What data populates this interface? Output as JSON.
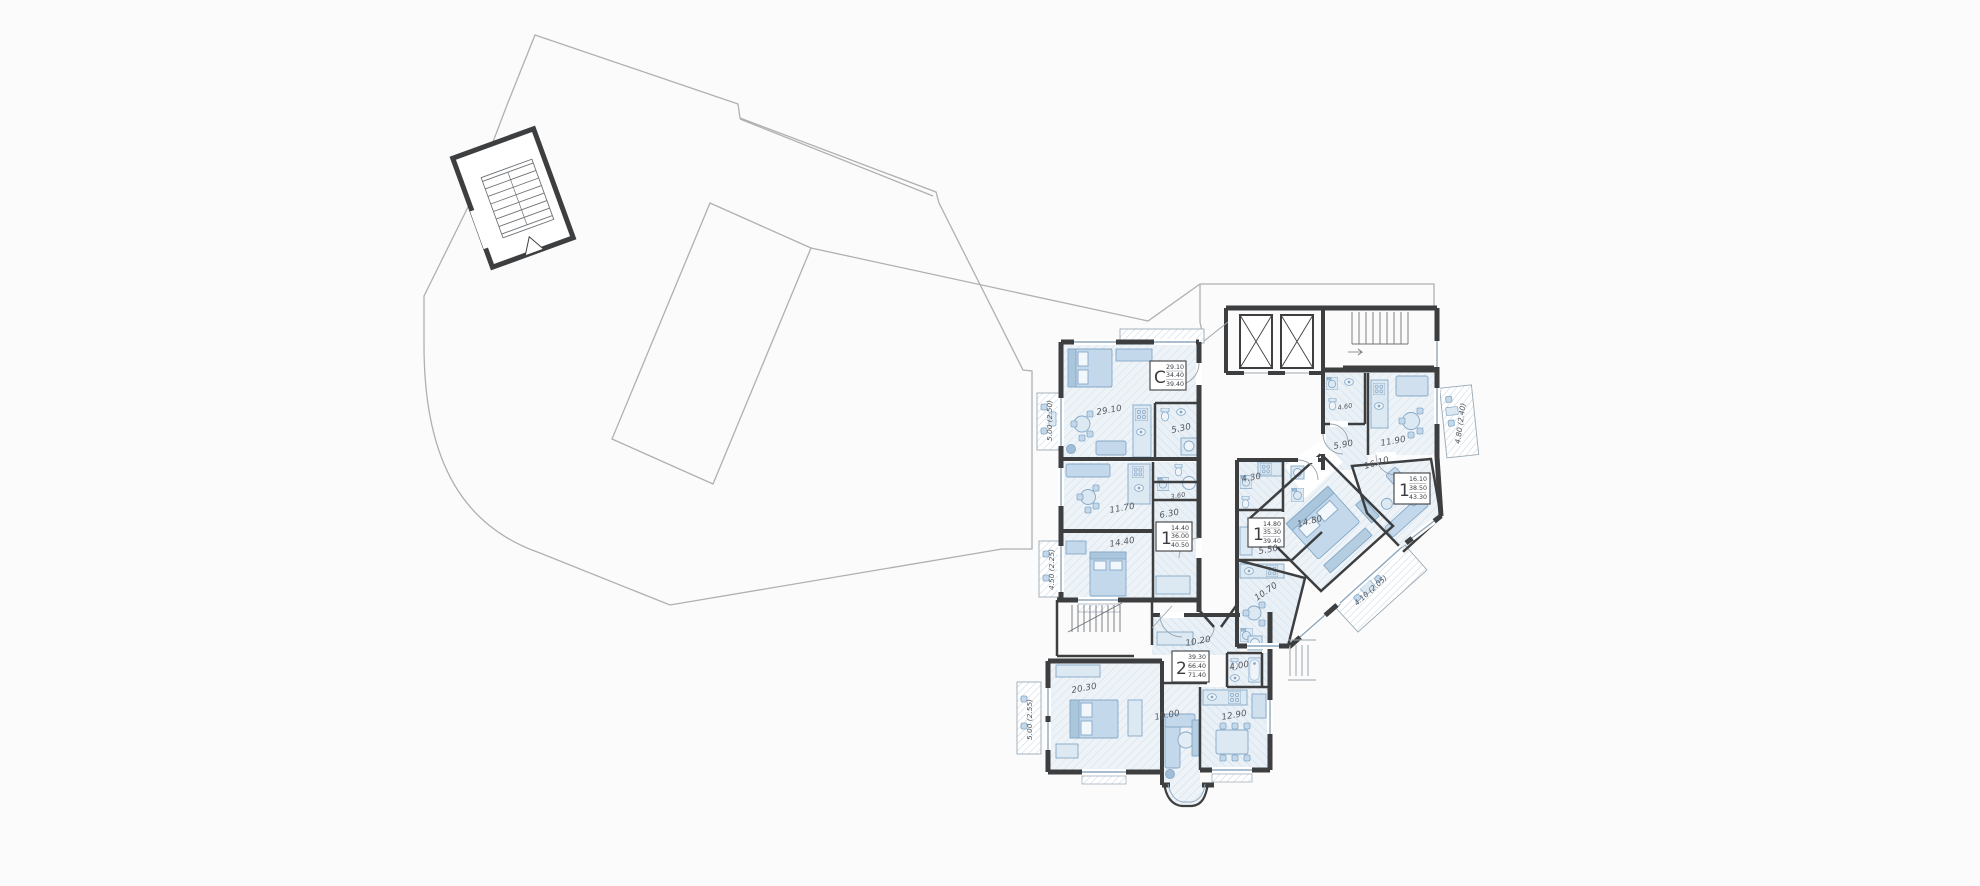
{
  "plan": {
    "apartments": [
      {
        "kind": "studio",
        "letter": "С",
        "living_area": "29.10",
        "area": "34.40",
        "total_area": "39.40"
      },
      {
        "kind": "one-room",
        "letter": "1",
        "living_area": "14.40",
        "area": "36.00",
        "total_area": "40.50"
      },
      {
        "kind": "one-room",
        "letter": "1",
        "living_area": "14.80",
        "area": "35.30",
        "total_area": "39.40"
      },
      {
        "kind": "one-room",
        "letter": "1",
        "living_area": "16.10",
        "area": "38.50",
        "total_area": "43.30"
      },
      {
        "kind": "two-room",
        "letter": "2",
        "living_area": "39.30",
        "area": "66.40",
        "total_area": "71.40"
      }
    ],
    "rooms": [
      "29.10",
      "5.30",
      "3.60",
      "11.70",
      "6.30",
      "14.40",
      "4.30",
      "5.50",
      "10.70",
      "14.80",
      "16.10",
      "5.90",
      "4.60",
      "11.90",
      "10.20",
      "4.00",
      "20.30",
      "19.00",
      "12.90"
    ],
    "balconies": [
      "5.00 (2.50)",
      "4.50 (2.25)",
      "5.00 (2.55)",
      "4.80 (2.40)",
      "4.10 (2.05)"
    ],
    "colors": {
      "wall": "#3c3e40",
      "outline": "#b0b0b0",
      "floor": "#edf3f8",
      "furniture": "#c3d8ea",
      "accent": "#8fa7bc"
    }
  }
}
